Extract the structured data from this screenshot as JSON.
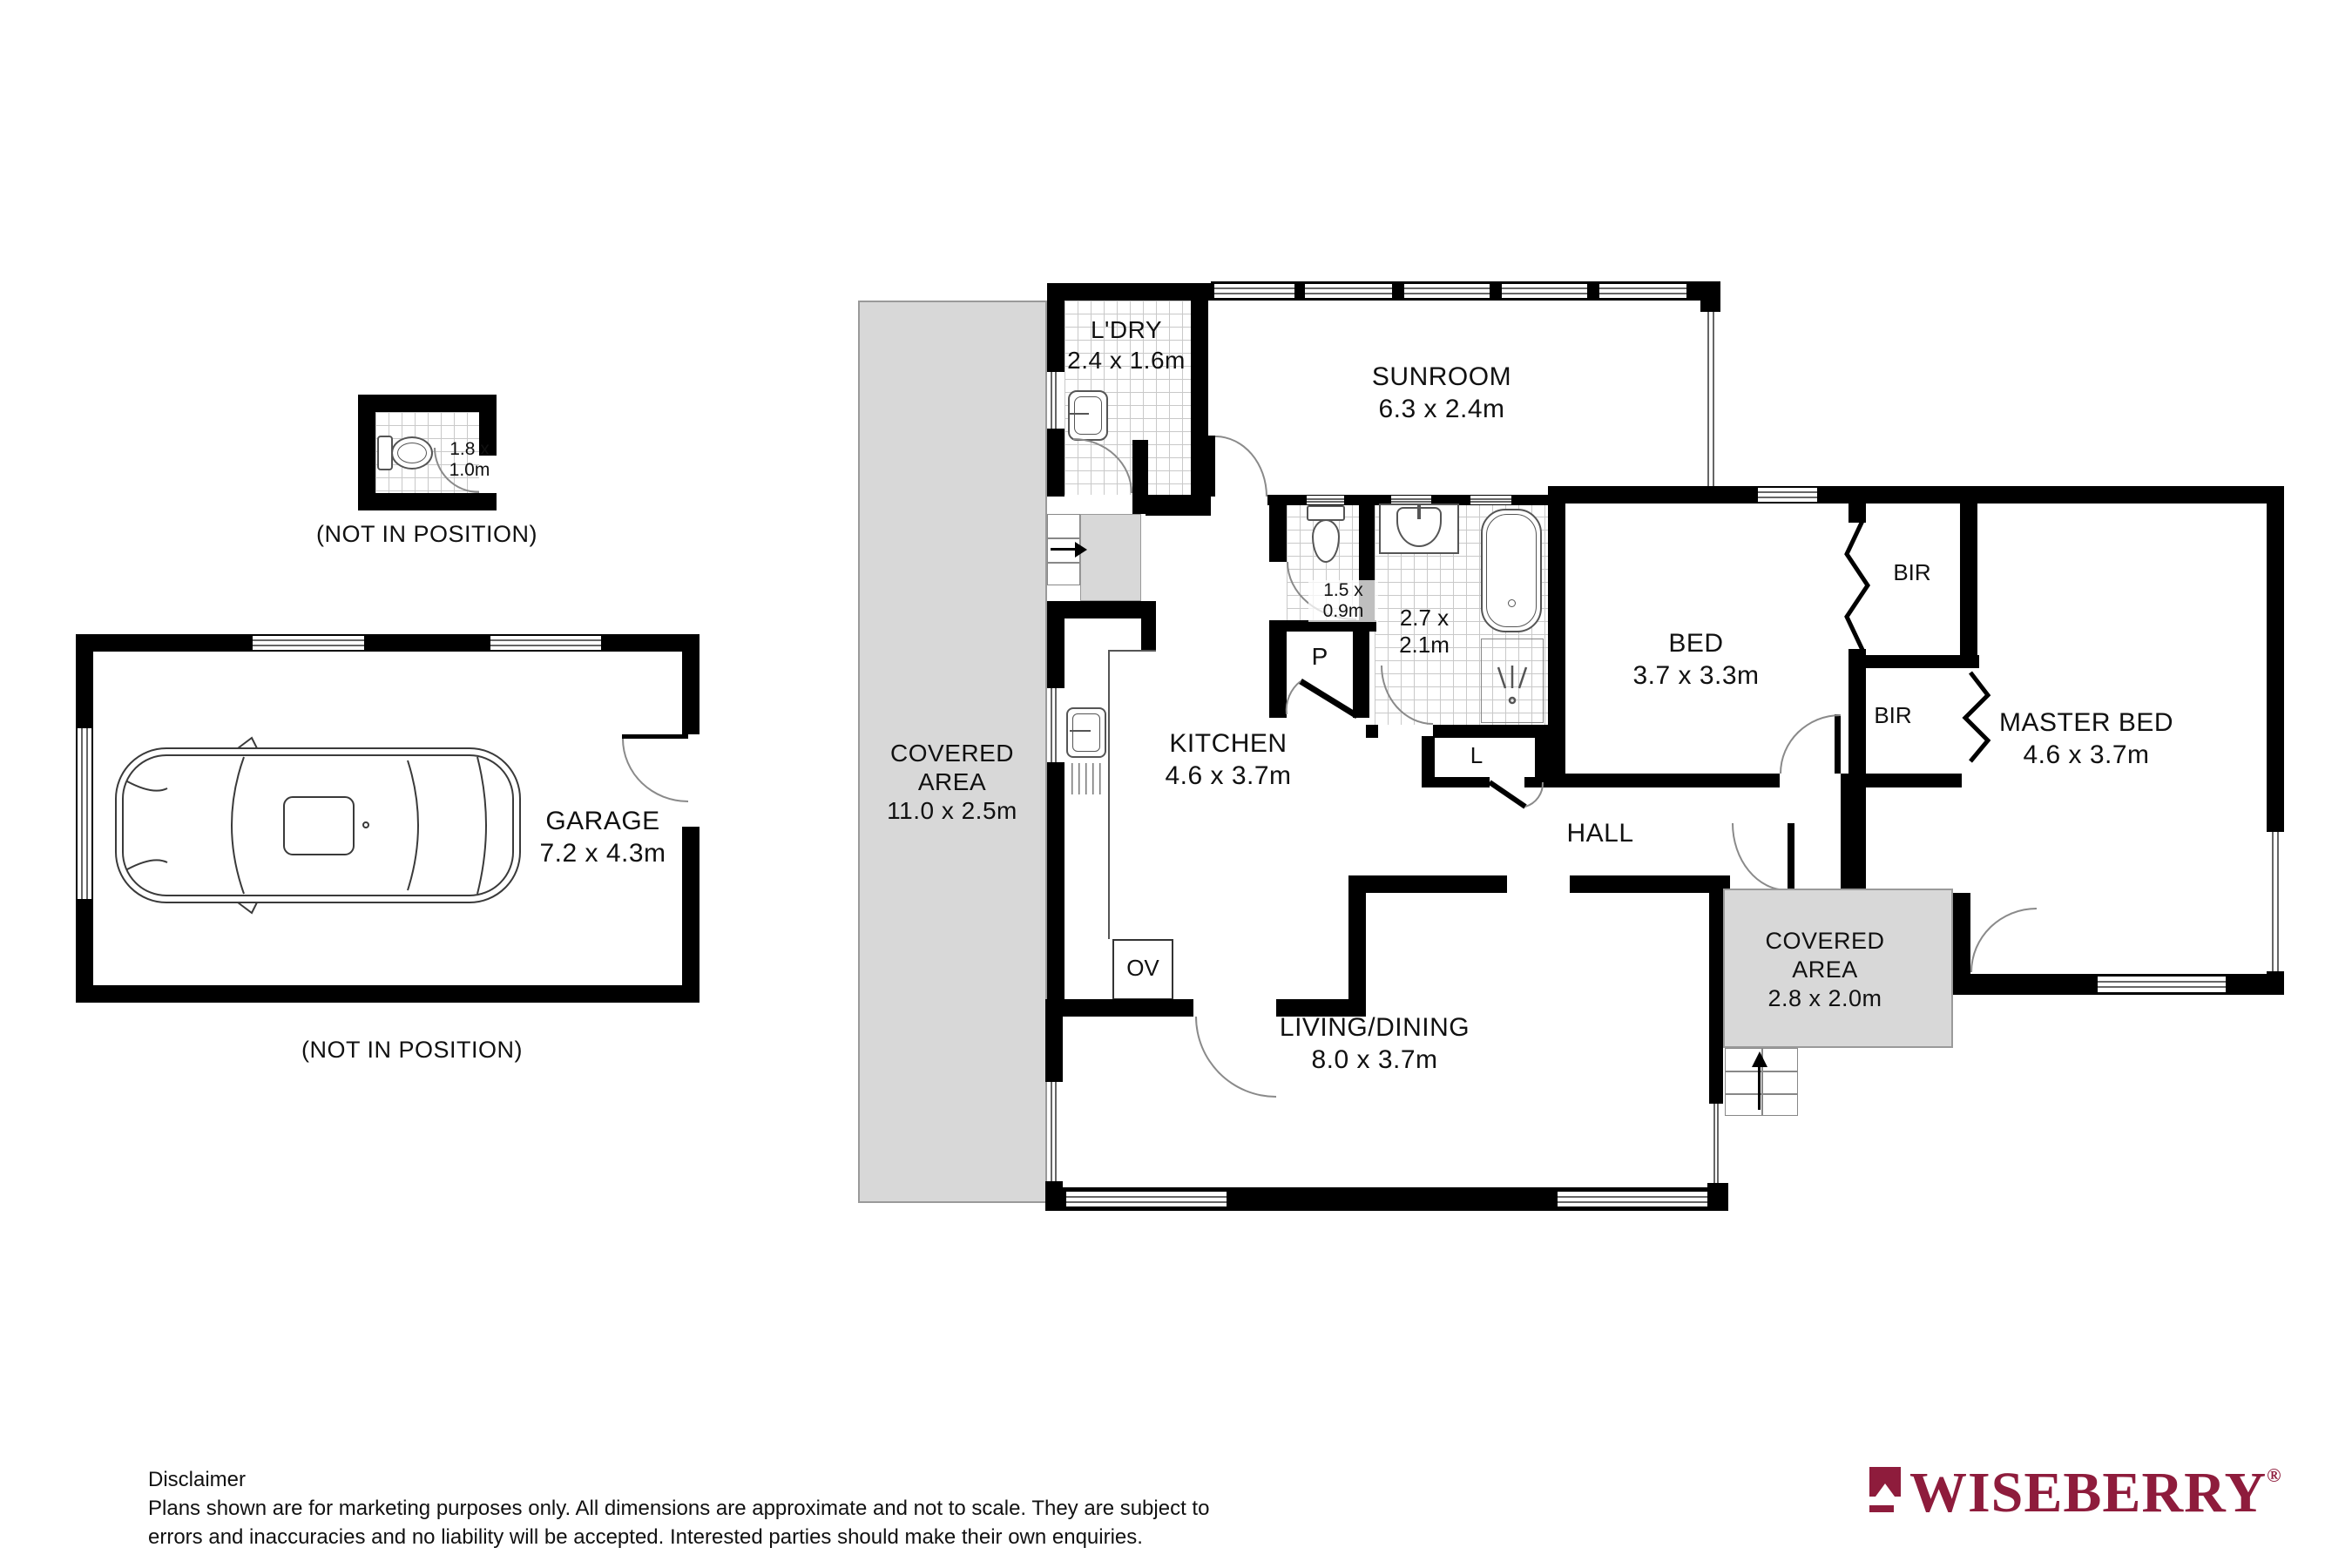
{
  "colors": {
    "wall": "#000000",
    "covered_area_fill": "#d8d8d8",
    "tile_line": "#c9c9c9",
    "brand_maroon": "#8e1c3c"
  },
  "plan": {
    "isolated_wc": {
      "dims_line1": "1.8 x",
      "dims_line2": "1.0m",
      "caption": "(NOT IN POSITION)",
      "icon": "toilet-icon"
    },
    "garage": {
      "label": "GARAGE",
      "dims": "7.2 x 4.3m",
      "caption": "(NOT IN POSITION)",
      "icon": "car-icon"
    },
    "covered_left": {
      "line1": "COVERED",
      "line2": "AREA",
      "dims": "11.0 x 2.5m"
    },
    "laundry": {
      "label": "L'DRY",
      "dims": "2.4 x 1.6m",
      "icon": "laundry-tub-icon"
    },
    "sunroom": {
      "label": "SUNROOM",
      "dims": "6.3 x 2.4m"
    },
    "wc": {
      "dims_line1": "1.5 x",
      "dims_line2": "0.9m",
      "icon": "toilet-icon"
    },
    "bathroom": {
      "dims_line1": "2.7 x",
      "dims_line2": "2.1m",
      "icons": [
        "vanity-basin-icon",
        "bathtub-icon",
        "shower-icon"
      ]
    },
    "pantry": {
      "label": "P"
    },
    "linen": {
      "label": "L"
    },
    "oven": {
      "label": "OV"
    },
    "kitchen": {
      "label": "KITCHEN",
      "dims": "4.6 x 3.7m",
      "icon": "kitchen-sink-icon"
    },
    "hall": {
      "label": "HALL"
    },
    "bed": {
      "label": "BED",
      "dims": "3.7 x 3.3m"
    },
    "bir_top": {
      "label": "BIR"
    },
    "bir_bottom": {
      "label": "BIR"
    },
    "master_bed": {
      "label": "MASTER BED",
      "dims": "4.6 x 3.7m"
    },
    "living_dining": {
      "label": "LIVING/DINING",
      "dims": "8.0 x 3.7m"
    },
    "covered_right": {
      "line1": "COVERED",
      "line2": "AREA",
      "dims": "2.8 x 2.0m"
    },
    "stairs": {
      "icon": "up-arrow-icon"
    },
    "entry_steps": {
      "icon": "right-arrow-icon"
    }
  },
  "footer": {
    "disclaimer_title": "Disclaimer",
    "disclaimer_line1": "Plans shown are for marketing purposes only. All dimensions are  approximate and not to scale. They are subject to",
    "disclaimer_line2": "errors and inaccuracies and  no liability will be accepted. Interested parties should make their own enquiries."
  },
  "brand": {
    "name": "WISEBERRY",
    "registered_mark": "®"
  }
}
